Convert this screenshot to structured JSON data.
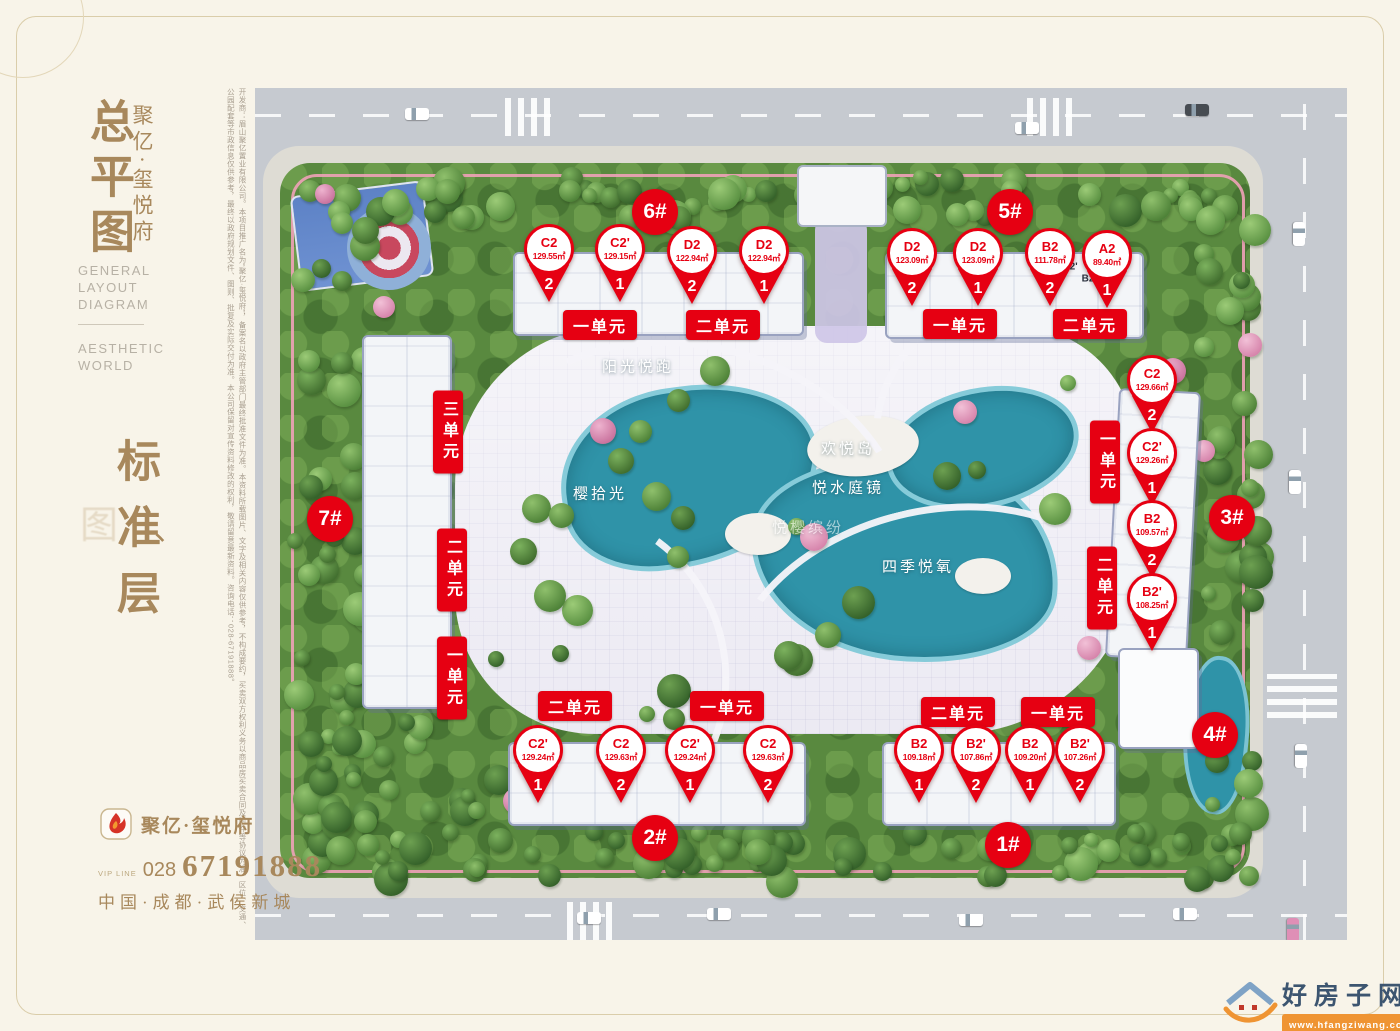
{
  "sidebar": {
    "title": "总平图",
    "title_ghost": "图",
    "brand": "聚亿·玺悦府",
    "en_title": [
      "GENERAL",
      "LAYOUT",
      "DIAGRAM"
    ],
    "en_tagline": [
      "AESTHETIC",
      "WORLD"
    ],
    "floor_label": "标准层",
    "floor_pause": "、",
    "disclaimer": "开发商：眉山聚亿置业有限公司。本项目推广名为“聚亿·玺悦府”，备案名以政府主管部门最终批准文件为准。本资料所载图片、文字及相关内容仅供参考，不构成要约，买卖双方权利义务以商品房买卖合同及附件等协议为准。区位、交通、公园配套等市政信息仅供参考，最终以政府规划文件、图则、批复及实际交付为准。本公司保留对宣传资料修改的权利，敬请留意最新资料。咨询电话：028-67191888。",
    "logo_brand": "聚亿·玺悦府",
    "vip_label": "VIP LINE",
    "area_code": "028",
    "phone": "67191888",
    "address": "中国·成都·武侯新城"
  },
  "map": {
    "badges": [
      {
        "label": "6#",
        "x": 655,
        "y": 212
      },
      {
        "label": "5#",
        "x": 1010,
        "y": 212
      },
      {
        "label": "7#",
        "x": 330,
        "y": 519
      },
      {
        "label": "3#",
        "x": 1232,
        "y": 518
      },
      {
        "label": "4#",
        "x": 1215,
        "y": 735
      },
      {
        "label": "2#",
        "x": 655,
        "y": 838
      },
      {
        "label": "1#",
        "x": 1008,
        "y": 845
      }
    ],
    "unit_labels": [
      {
        "text": "一单元",
        "x": 600,
        "y": 325,
        "vertical": false
      },
      {
        "text": "二单元",
        "x": 723,
        "y": 325,
        "vertical": false
      },
      {
        "text": "一单元",
        "x": 960,
        "y": 324,
        "vertical": false
      },
      {
        "text": "二单元",
        "x": 1090,
        "y": 324,
        "vertical": false
      },
      {
        "text": "三单元",
        "x": 448,
        "y": 432,
        "vertical": true
      },
      {
        "text": "二单元",
        "x": 452,
        "y": 570,
        "vertical": true
      },
      {
        "text": "一单元",
        "x": 452,
        "y": 678,
        "vertical": true
      },
      {
        "text": "一单元",
        "x": 1105,
        "y": 462,
        "vertical": true
      },
      {
        "text": "二单元",
        "x": 1102,
        "y": 588,
        "vertical": true
      },
      {
        "text": "二单元",
        "x": 575,
        "y": 706,
        "vertical": false
      },
      {
        "text": "一单元",
        "x": 727,
        "y": 706,
        "vertical": false
      },
      {
        "text": "二单元",
        "x": 958,
        "y": 712,
        "vertical": false
      },
      {
        "text": "一单元",
        "x": 1058,
        "y": 712,
        "vertical": false
      }
    ],
    "pins": [
      {
        "building": "6#",
        "type": "C2",
        "area": "129.55㎡",
        "unit_no": "2",
        "x": 549,
        "y": 224
      },
      {
        "building": "6#",
        "type": "C2'",
        "area": "129.15㎡",
        "unit_no": "1",
        "x": 620,
        "y": 224
      },
      {
        "building": "6#",
        "type": "D2",
        "area": "122.94㎡",
        "unit_no": "2",
        "x": 692,
        "y": 226
      },
      {
        "building": "6#",
        "type": "D2",
        "area": "122.94㎡",
        "unit_no": "1",
        "x": 764,
        "y": 226
      },
      {
        "building": "5#",
        "type": "D2",
        "area": "123.09㎡",
        "unit_no": "2",
        "x": 912,
        "y": 228
      },
      {
        "building": "5#",
        "type": "D2",
        "area": "123.09㎡",
        "unit_no": "1",
        "x": 978,
        "y": 228
      },
      {
        "building": "5#",
        "type": "B2",
        "area": "111.78㎡",
        "unit_no": "2",
        "x": 1050,
        "y": 228
      },
      {
        "building": "5#",
        "type": "A2",
        "area": "89.40㎡",
        "unit_no": "1",
        "x": 1107,
        "y": 230
      },
      {
        "building": "3#",
        "type": "C2",
        "area": "129.66㎡",
        "unit_no": "2",
        "x": 1152,
        "y": 355
      },
      {
        "building": "3#",
        "type": "C2'",
        "area": "129.26㎡",
        "unit_no": "1",
        "x": 1152,
        "y": 428
      },
      {
        "building": "3#",
        "type": "B2",
        "area": "109.57㎡",
        "unit_no": "2",
        "x": 1152,
        "y": 500
      },
      {
        "building": "3#",
        "type": "B2'",
        "area": "108.25㎡",
        "unit_no": "1",
        "x": 1152,
        "y": 573
      },
      {
        "building": "2#",
        "type": "C2'",
        "area": "129.24㎡",
        "unit_no": "1",
        "x": 538,
        "y": 725
      },
      {
        "building": "2#",
        "type": "C2",
        "area": "129.63㎡",
        "unit_no": "2",
        "x": 621,
        "y": 725
      },
      {
        "building": "2#",
        "type": "C2'",
        "area": "129.24㎡",
        "unit_no": "1",
        "x": 690,
        "y": 725
      },
      {
        "building": "2#",
        "type": "C2",
        "area": "129.63㎡",
        "unit_no": "2",
        "x": 768,
        "y": 725
      },
      {
        "building": "1#",
        "type": "B2",
        "area": "109.18㎡",
        "unit_no": "1",
        "x": 919,
        "y": 725
      },
      {
        "building": "1#",
        "type": "B2'",
        "area": "107.86㎡",
        "unit_no": "2",
        "x": 976,
        "y": 725
      },
      {
        "building": "1#",
        "type": "B2",
        "area": "109.20㎡",
        "unit_no": "1",
        "x": 1030,
        "y": 725
      },
      {
        "building": "1#",
        "type": "B2'",
        "area": "107.26㎡",
        "unit_no": "2",
        "x": 1080,
        "y": 725
      }
    ],
    "park_labels": [
      {
        "text": "阳光悦跑",
        "x": 638,
        "y": 366,
        "faint": false
      },
      {
        "text": "欢悦岛",
        "x": 848,
        "y": 448,
        "faint": false
      },
      {
        "text": "悦水庭镜",
        "x": 848,
        "y": 487,
        "faint": false
      },
      {
        "text": "悦樱缤纷",
        "x": 808,
        "y": 527,
        "faint": true
      },
      {
        "text": "樱拾光",
        "x": 600,
        "y": 493,
        "faint": false
      },
      {
        "text": "四季悦氧",
        "x": 918,
        "y": 566,
        "faint": false
      }
    ],
    "roof_notes": [
      {
        "text": "B2'",
        "x": 1070,
        "y": 267
      },
      {
        "text": "B2",
        "x": 1088,
        "y": 279
      }
    ]
  },
  "watermark": {
    "name": "好房子网",
    "url": "www.hfangziwang.com"
  },
  "colors": {
    "accent_red": "#e60012",
    "title_brown": "#a8885c",
    "pond_teal": "#2f93a8",
    "watermark_orange": "#ef9433"
  }
}
